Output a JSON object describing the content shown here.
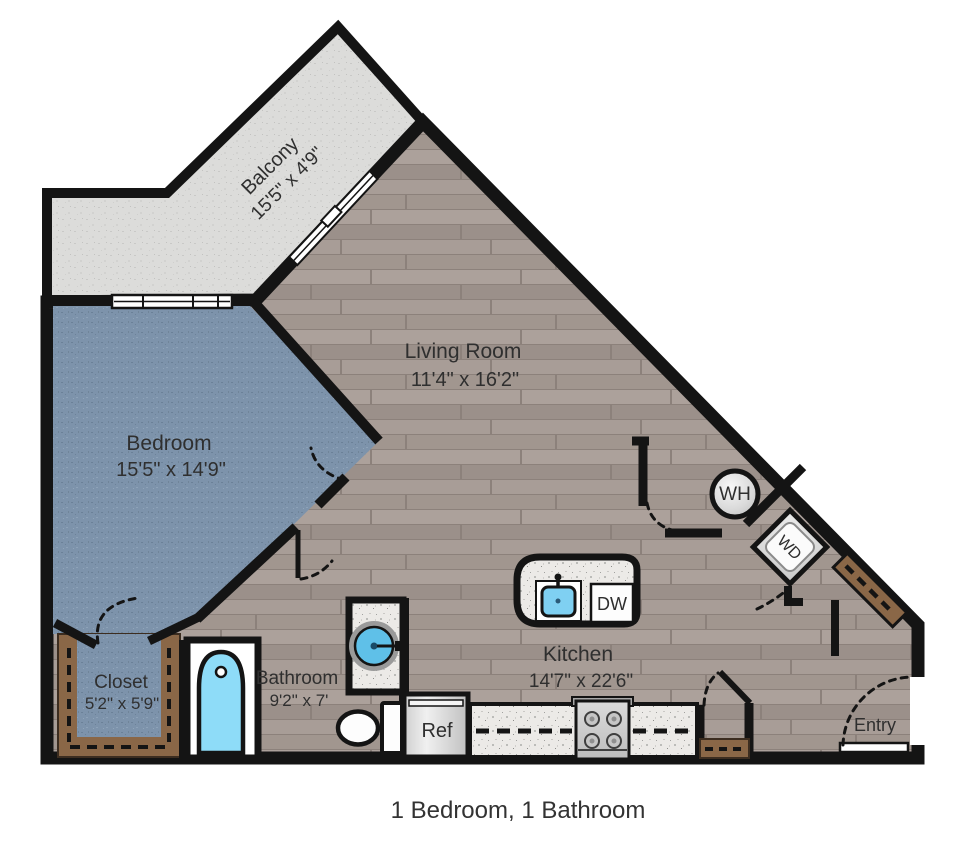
{
  "caption": "1 Bedroom,  1 Bathroom",
  "rooms": {
    "balcony": {
      "name": "Balcony",
      "dims": "15'5\" x 4'9\""
    },
    "living": {
      "name": "Living Room",
      "dims": "11'4\" x 16'2\""
    },
    "bedroom": {
      "name": "Bedroom",
      "dims": "15'5\" x 14'9\""
    },
    "closet": {
      "name": "Closet",
      "dims": "5'2\" x 5'9\""
    },
    "bathroom": {
      "name": "Bathroom",
      "dims": "9'2\" x 7'"
    },
    "kitchen": {
      "name": "Kitchen",
      "dims": "14'7\" x 22'6\""
    },
    "entry": {
      "name": "Entry"
    }
  },
  "appliances": {
    "water_heater": "WH",
    "washer_dryer": "WD",
    "dishwasher": "DW",
    "refrigerator": "Ref"
  },
  "colors": {
    "wall": "#141414",
    "wood_floor": "#a79c96",
    "carpet": "#7d93ab",
    "concrete": "#dcdcda",
    "countertop": "#eceae7",
    "cabinet_brown": "#8a6747",
    "fixture_blue": "#8edcf8",
    "text": "#2f2f2f"
  }
}
